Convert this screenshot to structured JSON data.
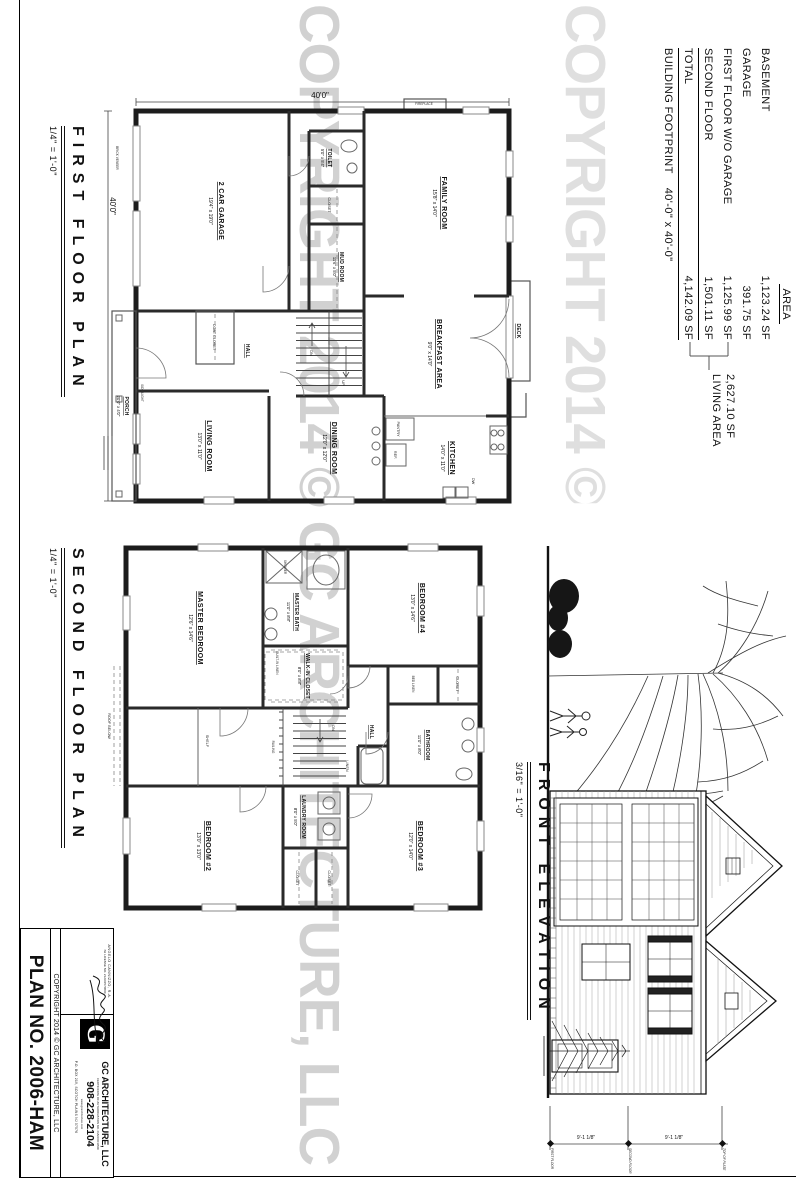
{
  "sheet": {
    "watermark": "COPYRIGHT 2014 © GC ARCHITECTURE, LLC"
  },
  "area": {
    "header": "AREA",
    "rows": [
      {
        "label": "BASEMENT",
        "value": "1,123.24 SF"
      },
      {
        "label": "GARAGE",
        "value": "391.75 SF"
      },
      {
        "label": "FIRST FLOOR W/O GARAGE",
        "value": "1,125.99 SF"
      },
      {
        "label": "SECOND FLOOR",
        "value": "1,501.11 SF"
      }
    ],
    "total_label": "TOTAL",
    "total_value": "4,142.09 SF",
    "footprint_label": "BUILDING FOOTPRINT",
    "footprint_value": "40'-0\" x 40'-0\"",
    "living_value": "2,627.10 SF",
    "living_label": "LIVING AREA"
  },
  "f1": {
    "title": "FIRST FLOOR PLAN",
    "scale": "1/4\" = 1'-0\"",
    "garage": "2 CAR GARAGE",
    "garage_d": "19'4\" x 19'0\"",
    "family": "FAMILY ROOM",
    "family_d": "15'8\" x 14'0\"",
    "breakfast": "BREAKFAST AREA",
    "breakfast_d": "9'0\" x 14'0\"",
    "kitchen": "KITCHEN",
    "kitchen_d": "14'0\" x 11'0\"",
    "dining": "DINING ROOM",
    "dining_d": "12'0\" x 12'0\"",
    "living": "LIVING ROOM",
    "living_d": "13'0\" x 11'0\"",
    "toilet": "TOILET",
    "toilet_d": "5'0\" x 5'4\"",
    "mud": "MUD ROOM",
    "mud_d": "11'6\" x 5'0\"",
    "porch": "PORCH",
    "porch_d": "20'0\" x 4'0\"",
    "hall": "HALL",
    "deck": "DECK",
    "fireplace": "FIREPLACE",
    "coat": "COAT CLOSET",
    "closet": "CLOSET",
    "pantry": "PANTRY",
    "ref": "REF.",
    "dw": "DW",
    "up": "UP",
    "dn": "DN",
    "dim": "40'0\"",
    "brick": "BRICK VENEER",
    "sidelight": "SIDE LIGHT"
  },
  "f2": {
    "title": "SECOND FLOOR PLAN",
    "scale": "1/4\" = 1'-0\"",
    "master": "MASTER BEDROOM",
    "master_d": "12'6\" x 14'6\"",
    "mbath": "MASTER BATH",
    "mbath_d": "11'0\" x 8'8\"",
    "wic": "WALK-IN CLOSET",
    "wic_d": "8'0\" x 8'8\"",
    "b2": "BEDROOM #2",
    "b2_d": "13'0\" x 13'0\"",
    "b3": "BEDROOM #3",
    "b3_d": "12'0\" x 14'0\"",
    "b4": "BEDROOM #4",
    "b4_d": "13'0\" x 14'6\"",
    "bath": "BATHROOM",
    "bath_d": "11'0\" x 8'0\"",
    "laundry": "LAUNDRY ROOM",
    "laundry_d": "8'0\" x 5'0\"",
    "hall": "HALL",
    "shelf": "SHELF",
    "linen": "LINEN",
    "bedlinen": "BED LINEN",
    "builtin": "BUILT-IN LINEN",
    "railing": "RAILING",
    "roofbelow": "ROOF BELOW",
    "shower": "SHOWER",
    "closet": "CLOSET",
    "dn": "DN"
  },
  "elev": {
    "title": "FRONT ELEVATION",
    "scale": "3/16\" = 1'-0\"",
    "dim_upper": "9'-1 1/8\"",
    "dim_lower": "9'-1 1/8\"",
    "lvl_top": "TOP OF PLATE",
    "lvl_mid": "SECOND FLOOR",
    "lvl_bot": "FIRST FLOOR"
  },
  "tb": {
    "plan_no": "PLAN NO. 2006-HAM",
    "copyright": "COPYRIGHT 2014 © GC ARCHITECTURE, LLC",
    "firm": "GC ARCHITECTURE, LLC",
    "phone": "908-228-2104",
    "cert": "CERTIFICATE OF AUTHORIZATION NO. 21AC00010500",
    "web": "www.gcarchitecture.com",
    "addr": "P.O. BOX 219, SCOTCH PLAINS NJ 07076",
    "architect": "ANGELO CANNIZZO, R.A.",
    "license": "NJ LICENSE NO. 21AI01570800",
    "logo": "G"
  }
}
